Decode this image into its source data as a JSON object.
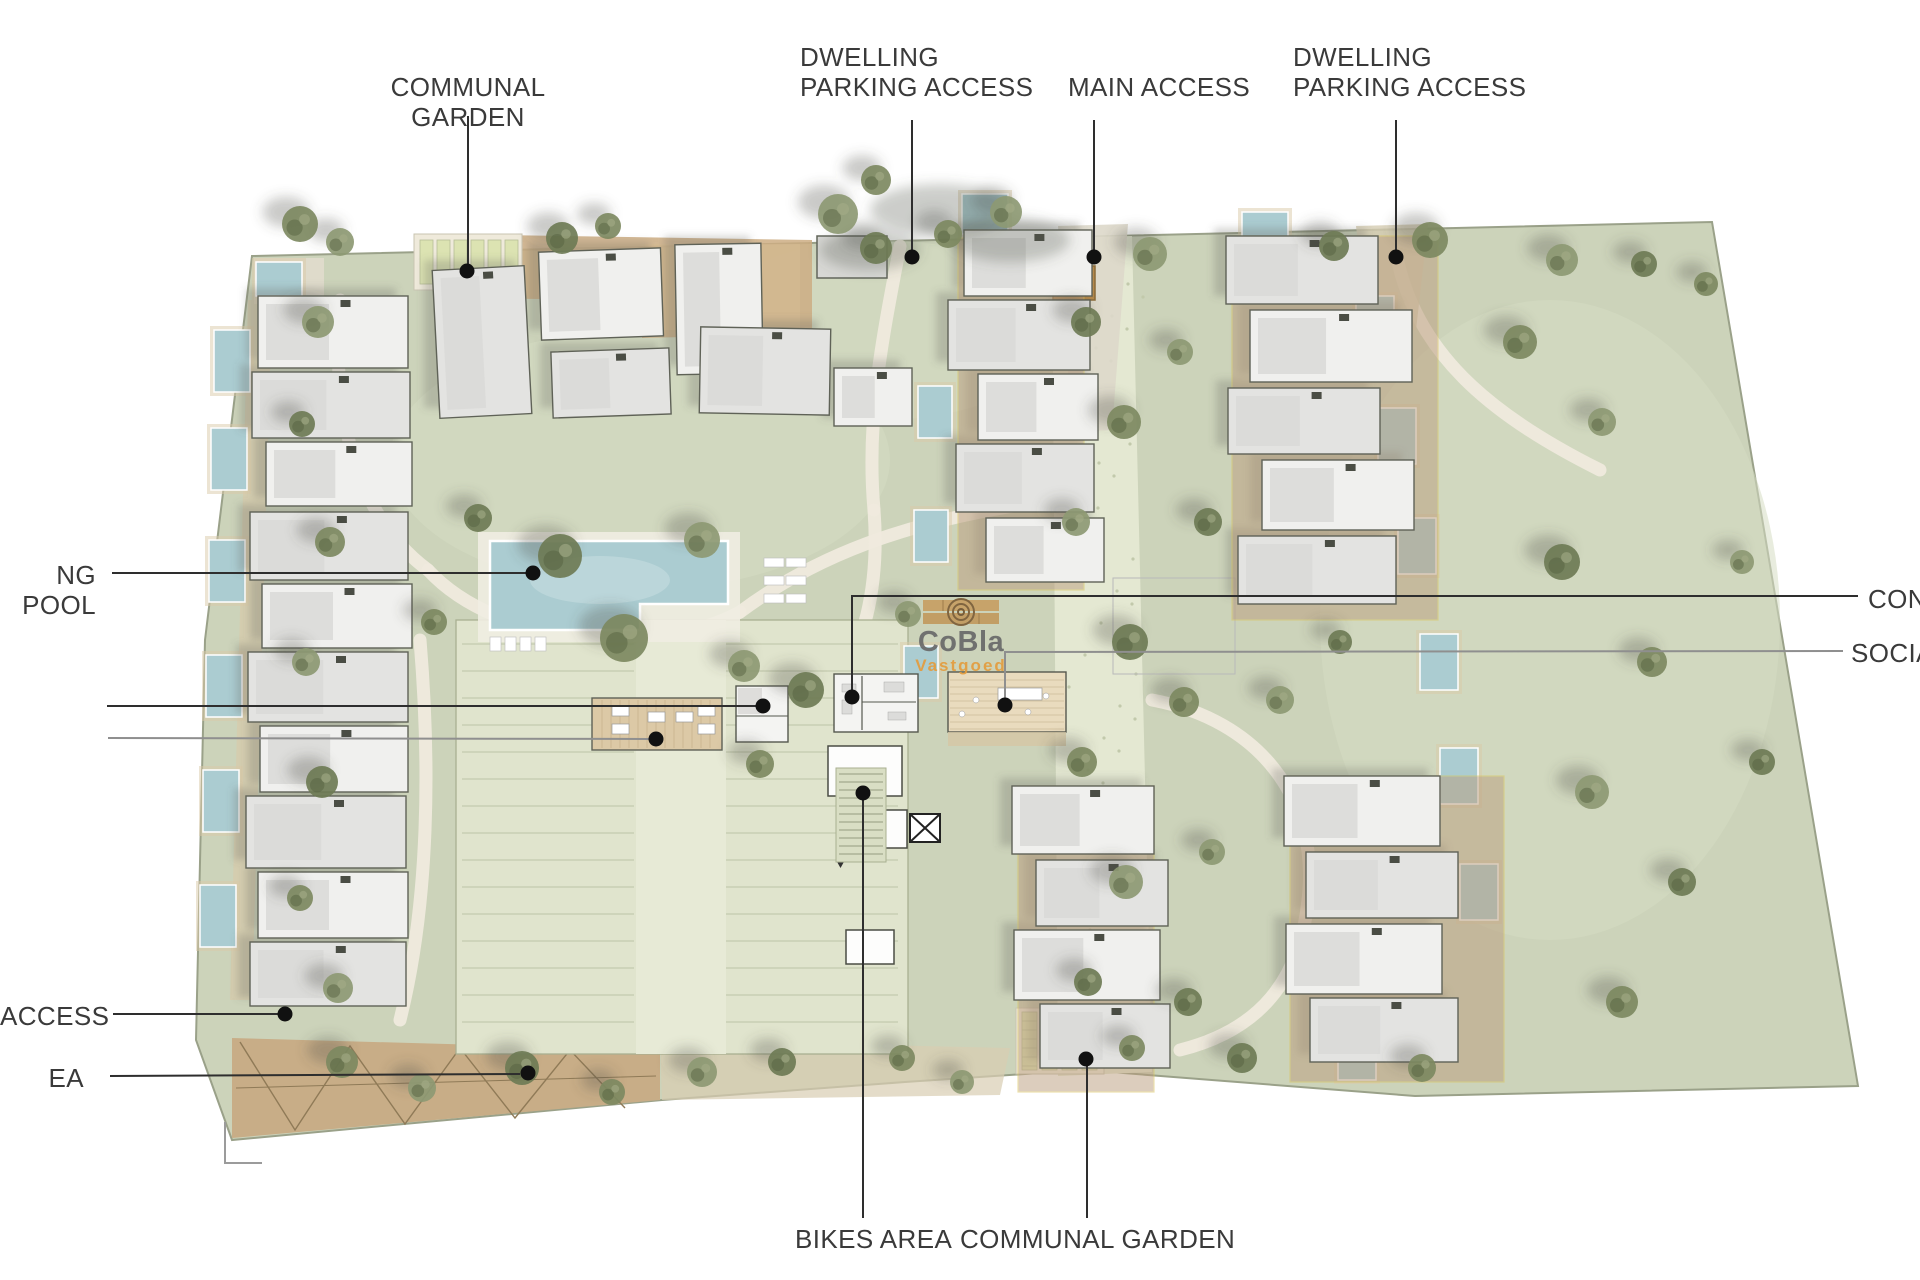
{
  "watermark": {
    "brand": "CoBla",
    "sub": "Vastgoed"
  },
  "callouts": {
    "communal_garden_top": "COMMUNAL GARDEN",
    "dwelling_parking_left": "DWELLING\nPARKING ACCESS",
    "main_access": "MAIN ACCESS",
    "dwelling_parking_right": "DWELLING\nPARKING ACCESS",
    "swimming_pool": "NG POOL",
    "access": "ACCESS",
    "ea": "EA",
    "bikes_area": "BIKES AREA",
    "communal_garden_bottom": "COMMUNAL GARDEN",
    "concierge": "CON",
    "social": "SOCIA"
  },
  "colors": {
    "label_text": "#3a3a3a",
    "leader_dark": "#2e2e2e",
    "leader_grey": "#8f8f8f",
    "lawn": "#ccd3ba",
    "paving": "#e4e8d2",
    "wood_deck": "#ccad83",
    "pool_water": "#abccd1",
    "building_fill": "#f2f2f0",
    "building_stroke": "#5f6257",
    "patio_brick": "#b99b7d",
    "watermark_grey": "#696969",
    "watermark_orange": "#e39c3d"
  }
}
